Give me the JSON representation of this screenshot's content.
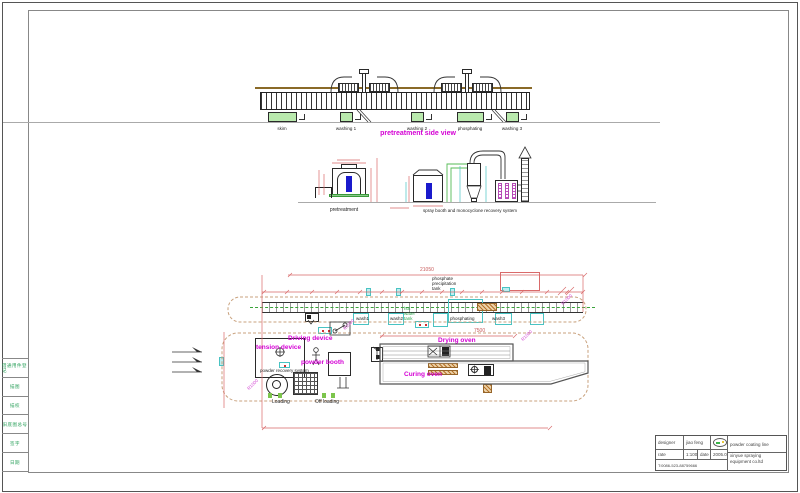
{
  "side_view": {
    "title": "pretreatment side view",
    "stations": [
      "skim",
      "washing 1",
      "washing 2",
      "phosphating",
      "washing 3"
    ]
  },
  "elevation": {
    "pretreatment_label": "pretreatment",
    "spray_label": "spray booth and monocyclone recovery system"
  },
  "plan": {
    "note_lines": [
      "phosphate",
      "precipitation",
      "tank"
    ],
    "green_note_lines": [
      "hot",
      "water",
      "tank"
    ],
    "driving_label": "Driving device",
    "tension_label": "tension device",
    "booth_label": "powder booth",
    "recovery_label": "powder recovery system",
    "drying_label": "Drying oven",
    "curing_label": "Curing oven",
    "loading_label": "Loading",
    "offloading_label": "Off loading",
    "tank_labels": [
      "wash1",
      "wash2",
      "phosphating",
      "wash3"
    ],
    "dim_total": "21050",
    "dim_oven": "7500",
    "radius_callout": "R1000"
  },
  "title_block": {
    "designer_label": "designer",
    "designer_value": "jiao feng",
    "rate_label": "rate",
    "rate_value": "1:100",
    "date_label": "date",
    "date_value": "2005.07",
    "phone": "T:0086-523-88759666",
    "product": "powder coating line",
    "company_line1": "xinyue spraying",
    "company_line2": "equipment co.ltd"
  },
  "revision_strip": {
    "cells": [
      "借通用件登记",
      "描图",
      "描校",
      "旧底图总号",
      "签字",
      "日期"
    ]
  },
  "colors": {
    "magenta": "#d400d4",
    "dim_red": "#d96a6a",
    "cyan": "#49c3c3",
    "tank_green": "#b9e9ad",
    "loop_tan": "#c9a27e",
    "blue": "#1a1acc",
    "strip_green": "#2aa05a",
    "brown_line": "#8a6a28"
  }
}
